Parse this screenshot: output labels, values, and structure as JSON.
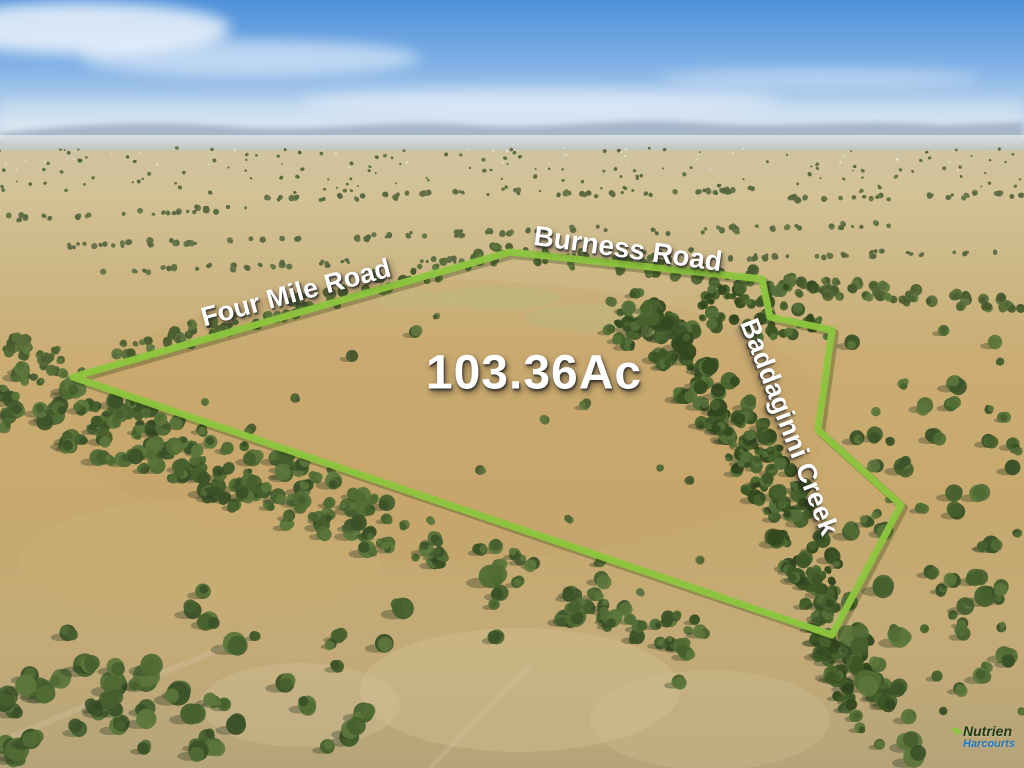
{
  "photo": {
    "description": "Aerial photograph of rural farmland property for sale with boundary overlay",
    "area_label": "103.36Ac",
    "road_labels": {
      "four_mile": "Four Mile Road",
      "burness": "Burness Road"
    },
    "creek_label": "Baddaginni Creek",
    "boundary": {
      "color": "#8ec63e",
      "points": "73,377 510,252 762,279 770,317 832,330 818,430 901,505 832,635"
    }
  },
  "branding": {
    "name": "Nutrien",
    "sub_name": "Harcourts",
    "name_color": "#1c3b17",
    "sub_name_color": "#1e78c8",
    "leaf_color": "#8dc63f"
  }
}
